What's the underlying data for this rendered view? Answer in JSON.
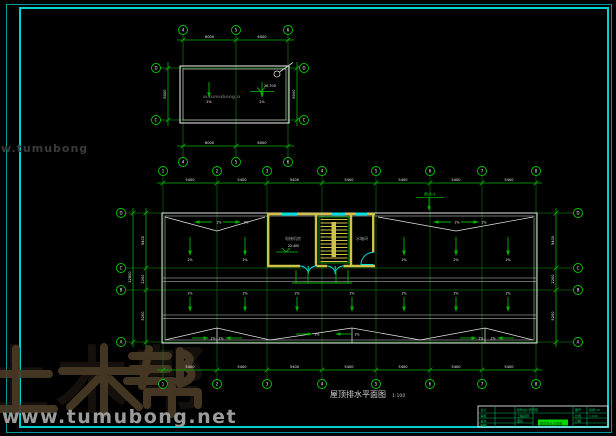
{
  "colors": {
    "frame_cyan": "#00d2d2",
    "grid_green": "#00b400",
    "wall_yellow": "#cfc24a",
    "line_white": "#e0e0e0",
    "window_cyan": "#00e0e0",
    "title_green": "#00b45a",
    "highlight_green": "#00d800",
    "watermark_gray": "#9c9c9c",
    "watermark_brown": "#4a3b26"
  },
  "watermark": {
    "brand": "土木帮",
    "url": "www.tumubong.net",
    "side_text": "w.tumubong",
    "inner_text": "w.tumubong.n"
  },
  "drawing_title": {
    "name": "屋顶排水平面图",
    "scale": "1:100"
  },
  "upper_plan": {
    "bubbles_top": [
      "4",
      "5",
      "6"
    ],
    "bubbles_bottom": [
      "4",
      "5",
      "6"
    ],
    "bubbles_left": [
      "D",
      "C"
    ],
    "bubbles_right": [
      "D",
      "C"
    ],
    "dims_top": [
      "6000",
      "6000"
    ],
    "dims_bottom": [
      "6000",
      "6000"
    ],
    "dim_left": "6000",
    "dim_right": "6000",
    "slope_label": "2%",
    "elevation": "26.700"
  },
  "main_plan": {
    "bubbles_top": [
      "1",
      "2",
      "3",
      "4",
      "5",
      "6",
      "7",
      "8"
    ],
    "bubbles_bottom": [
      "1",
      "2",
      "3",
      "4",
      "5",
      "6",
      "7",
      "8"
    ],
    "bubbles_left": [
      "D",
      "C",
      "B",
      "A"
    ],
    "bubbles_right": [
      "D",
      "C",
      "B",
      "A"
    ],
    "dims_top": [
      "5400",
      "5400",
      "5400",
      "5400",
      "5400",
      "5400",
      "5400"
    ],
    "dims_bottom": [
      "5400",
      "5400",
      "5400",
      "5400",
      "5400",
      "5400",
      "5400"
    ],
    "dims_left": [
      "5400",
      "2200",
      "5200"
    ],
    "dims_right": [
      "5400",
      "2200",
      "5200"
    ],
    "dim_left_total": "12800",
    "slope_label": "2%",
    "rooms": {
      "machine_room": "电梯机房",
      "tank_room": "水箱间"
    },
    "elevation": "22.400",
    "leader_label": "雨水斗"
  },
  "title_block": {
    "design_label": "设计",
    "check_label": "审核",
    "proof_label": "校对",
    "draw_label": "制图",
    "company": "建筑设计研究院",
    "project_label": "工程名称",
    "sheet_label": "图名",
    "sheet_name": "屋顶排水平面图",
    "no_label": "图号",
    "no": "建施-12",
    "scale_label": "比例",
    "scale": "1:100",
    "date_label": "日期"
  }
}
